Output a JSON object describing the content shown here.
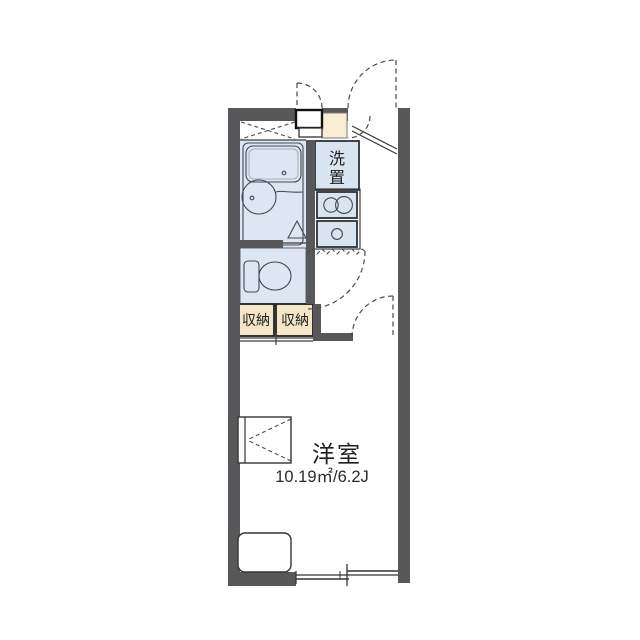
{
  "floorplan": {
    "type": "apartment-floor-plan-1K",
    "labels": {
      "laundry": [
        "洗",
        "置"
      ],
      "storage_left": "収納",
      "storage_right": "収納",
      "main_room": "洋室",
      "main_room_area": "10.19㎡/6.2J"
    },
    "colors": {
      "wall": "#58585a",
      "wet_area_floor": "#dce7f3",
      "fixture_fill": "#e9f1f9",
      "kitchen_unit_fill": "#d9e4f1",
      "genkan_tile": "#f8ecd4",
      "storage_fill": "#f4e6c6",
      "line": "#3c3c3c",
      "text": "#1f1f1f",
      "background": "#ffffff"
    }
  }
}
